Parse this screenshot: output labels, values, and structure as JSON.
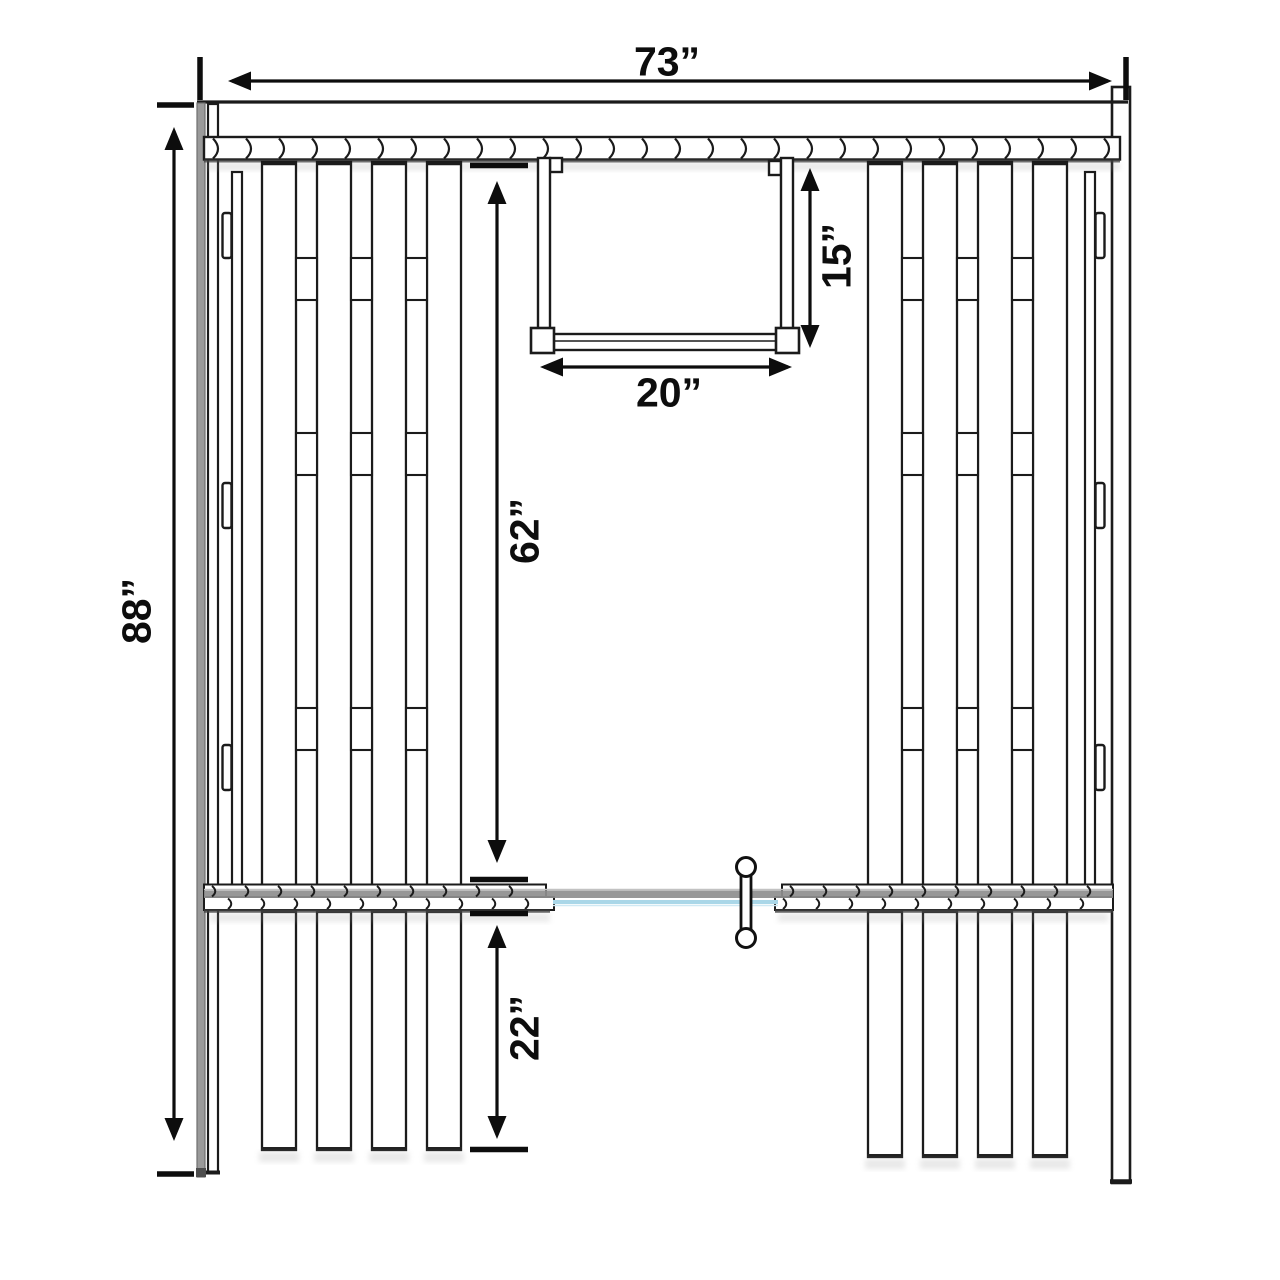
{
  "diagram": {
    "dimensions": {
      "overall_width": {
        "label": "73”"
      },
      "overall_height": {
        "label": "88”"
      },
      "upper_wall_height": {
        "label": "62”"
      },
      "lower_panel_height": {
        "label": "22”"
      },
      "window_height": {
        "label": "15”"
      },
      "window_width": {
        "label": "20”"
      }
    },
    "colors": {
      "line": "#1b1b1b",
      "dimension": "#0d0d0d",
      "post_gray": "#9a9a9a",
      "door_track_gray": "#8e8e8e",
      "glass_blue": "#aad7e8",
      "shade_dark": "#3d3d3d"
    }
  }
}
